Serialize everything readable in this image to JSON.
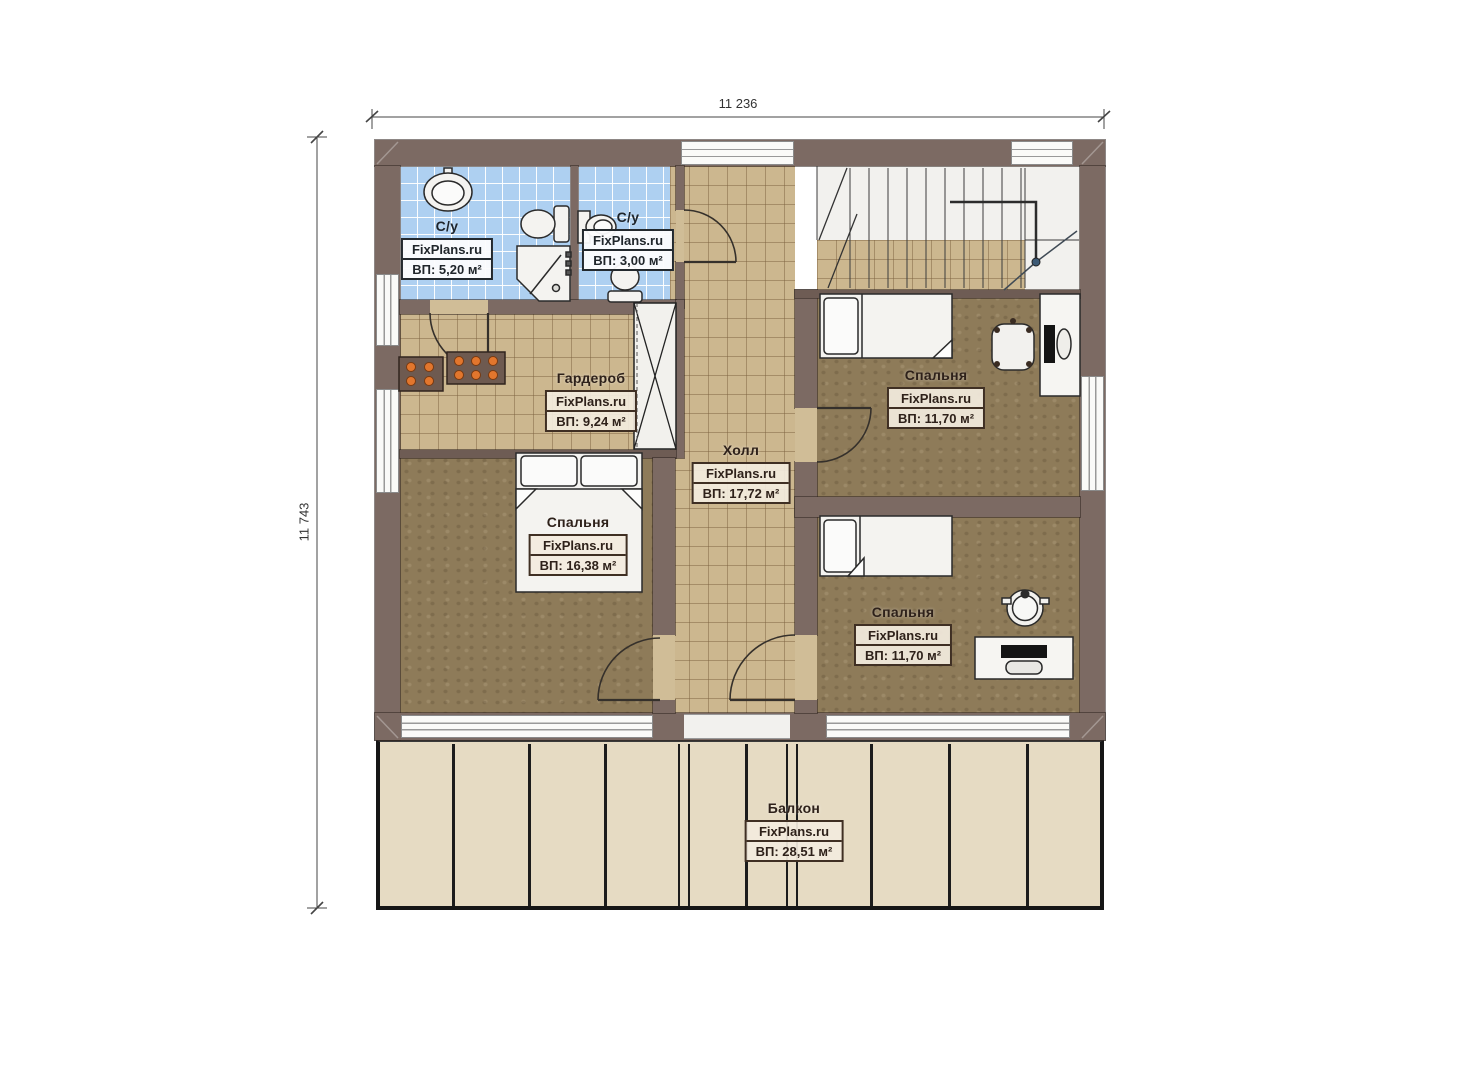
{
  "dimensions": {
    "width": "11 236",
    "height": "11 743"
  },
  "watermark": "FixPlans.ru",
  "rooms": {
    "bath_large": {
      "name": "С/у",
      "brand": "FixPlans.ru",
      "area": "ВП: 5,20 м²"
    },
    "bath_small": {
      "name": "С/у",
      "brand": "FixPlans.ru",
      "area": "ВП: 3,00 м²"
    },
    "wardrobe": {
      "name": "Гардероб",
      "brand": "FixPlans.ru",
      "area": "ВП: 9,24 м²"
    },
    "hall": {
      "name": "Холл",
      "brand": "FixPlans.ru",
      "area": "ВП: 17,72 м²"
    },
    "bedroom_top_right": {
      "name": "Спальня",
      "brand": "FixPlans.ru",
      "area": "ВП: 11,70 м²"
    },
    "bedroom_left": {
      "name": "Спальня",
      "brand": "FixPlans.ru",
      "area": "ВП: 16,38 м²"
    },
    "bedroom_bottom_right": {
      "name": "Спальня",
      "brand": "FixPlans.ru",
      "area": "ВП: 11,70 м²"
    },
    "balcony": {
      "name": "Балкон",
      "brand": "FixPlans.ru",
      "area": "ВП: 28,51 м²"
    }
  },
  "colors": {
    "wall": "#7c6a63",
    "tile_floor": "#ccb78f",
    "bedroom_floor": "#8e7b59",
    "bath_tile": "#aed0f1",
    "balcony_floor": "#e6dbc3"
  }
}
